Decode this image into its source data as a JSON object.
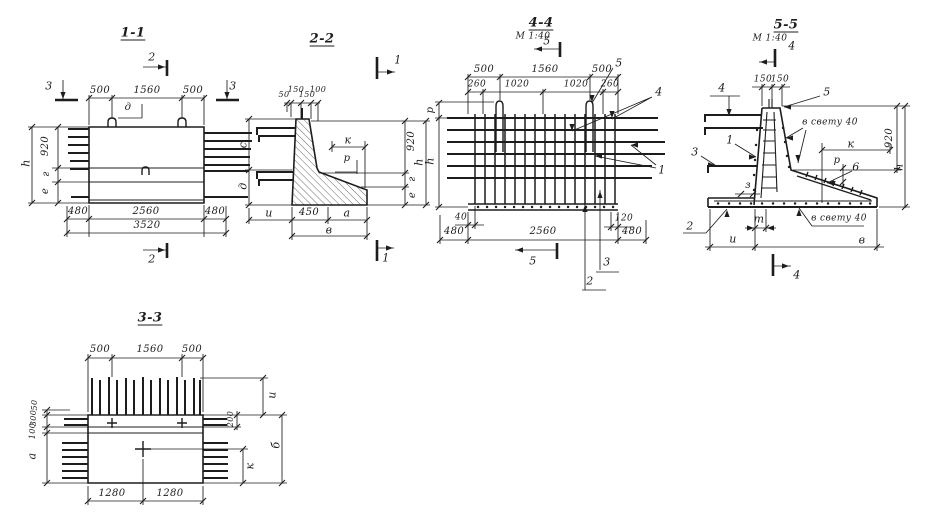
{
  "drawing": {
    "paper_color": "#ffffff",
    "ink_color": "#1d1d1d"
  },
  "views": [
    {
      "id": "section-1-1",
      "labels": [
        {
          "t": "1-1",
          "x": 133,
          "y": 33,
          "s": 13,
          "u": 1,
          "n": "view-title-1-1"
        },
        {
          "t": "2",
          "x": 152,
          "y": 57,
          "n": "section-mark-label"
        },
        {
          "t": "2",
          "x": 152,
          "y": 259,
          "n": "section-mark-label"
        },
        {
          "t": "3",
          "x": 49,
          "y": 86,
          "n": "section-mark-label"
        },
        {
          "t": "3",
          "x": 233,
          "y": 86,
          "n": "section-mark-label"
        },
        {
          "t": "500",
          "x": 100,
          "y": 91,
          "s": 10,
          "n": "dim-label"
        },
        {
          "t": "1560",
          "x": 147,
          "y": 91,
          "s": 10,
          "n": "dim-label"
        },
        {
          "t": "500",
          "x": 193,
          "y": 91,
          "s": 10,
          "n": "dim-label"
        },
        {
          "t": "д",
          "x": 128,
          "y": 108,
          "s": 10,
          "n": "param-label"
        },
        {
          "t": "920",
          "x": 46,
          "y": 146,
          "r": 1,
          "s": 10,
          "n": "dim-label"
        },
        {
          "t": "г",
          "x": 47,
          "y": 174,
          "r": 1,
          "s": 10,
          "n": "param-label"
        },
        {
          "t": "е",
          "x": 46,
          "y": 191,
          "r": 1,
          "s": 10,
          "n": "param-label"
        },
        {
          "t": "h",
          "x": 26,
          "y": 163,
          "r": 1,
          "n": "param-label"
        },
        {
          "t": "480",
          "x": 78,
          "y": 212,
          "s": 10,
          "n": "dim-label"
        },
        {
          "t": "2560",
          "x": 146,
          "y": 212,
          "s": 10,
          "n": "dim-label"
        },
        {
          "t": "480",
          "x": 215,
          "y": 212,
          "s": 10,
          "n": "dim-label"
        },
        {
          "t": "3520",
          "x": 147,
          "y": 226,
          "s": 10,
          "n": "dim-label"
        }
      ]
    },
    {
      "id": "section-2-2",
      "labels": [
        {
          "t": "2-2",
          "x": 322,
          "y": 39,
          "s": 13,
          "u": 1,
          "n": "view-title-2-2"
        },
        {
          "t": "1",
          "x": 398,
          "y": 60,
          "n": "section-mark-label"
        },
        {
          "t": "1",
          "x": 386,
          "y": 258,
          "n": "section-mark-label"
        },
        {
          "t": "50",
          "x": 284,
          "y": 95,
          "s": 8,
          "n": "dim-label"
        },
        {
          "t": "150",
          "x": 296,
          "y": 90,
          "s": 8,
          "n": "dim-label"
        },
        {
          "t": "150",
          "x": 307,
          "y": 95,
          "s": 8,
          "n": "dim-label"
        },
        {
          "t": "100",
          "x": 318,
          "y": 90,
          "s": 8,
          "n": "dim-label"
        },
        {
          "t": "с",
          "x": 243,
          "y": 145,
          "r": 1,
          "n": "param-label"
        },
        {
          "t": "д",
          "x": 243,
          "y": 186,
          "r": 1,
          "n": "param-label"
        },
        {
          "t": "и",
          "x": 269,
          "y": 213,
          "n": "param-label"
        },
        {
          "t": "450",
          "x": 309,
          "y": 213,
          "s": 10,
          "n": "dim-label"
        },
        {
          "t": "а",
          "x": 347,
          "y": 213,
          "n": "param-label"
        },
        {
          "t": "в",
          "x": 329,
          "y": 230,
          "n": "param-label"
        },
        {
          "t": "к",
          "x": 348,
          "y": 140,
          "n": "param-label"
        },
        {
          "t": "р",
          "x": 347,
          "y": 159,
          "s": 10,
          "n": "param-label"
        },
        {
          "t": "920",
          "x": 412,
          "y": 141,
          "r": 1,
          "s": 10,
          "n": "dim-label"
        },
        {
          "t": "г",
          "x": 413,
          "y": 179,
          "r": 1,
          "s": 10,
          "n": "param-label"
        },
        {
          "t": "е",
          "x": 413,
          "y": 195,
          "r": 1,
          "s": 10,
          "n": "param-label"
        },
        {
          "t": "h",
          "x": 419,
          "y": 162,
          "r": 1,
          "n": "param-label"
        }
      ]
    },
    {
      "id": "section-4-4",
      "labels": [
        {
          "t": "4-4",
          "x": 541,
          "y": 23,
          "s": 13,
          "u": 1,
          "n": "view-title-4-4"
        },
        {
          "t": "М 1:40",
          "x": 533,
          "y": 37,
          "s": 9,
          "n": "scale-label"
        },
        {
          "t": "5",
          "x": 547,
          "y": 41,
          "n": "section-mark-label"
        },
        {
          "t": "500",
          "x": 484,
          "y": 70,
          "s": 10,
          "n": "dim-label"
        },
        {
          "t": "1560",
          "x": 545,
          "y": 70,
          "s": 10,
          "n": "dim-label"
        },
        {
          "t": "500",
          "x": 602,
          "y": 70,
          "s": 10,
          "n": "dim-label"
        },
        {
          "t": "260",
          "x": 477,
          "y": 85,
          "s": 9,
          "n": "dim-label"
        },
        {
          "t": "1020",
          "x": 517,
          "y": 85,
          "s": 9,
          "n": "dim-label"
        },
        {
          "t": "1020",
          "x": 576,
          "y": 85,
          "s": 9,
          "n": "dim-label"
        },
        {
          "t": "260",
          "x": 610,
          "y": 85,
          "s": 9,
          "n": "dim-label"
        },
        {
          "t": "5",
          "x": 619,
          "y": 63,
          "n": "callout-label"
        },
        {
          "t": "4",
          "x": 659,
          "y": 92,
          "n": "callout-label"
        },
        {
          "t": "1",
          "x": 662,
          "y": 170,
          "n": "callout-label"
        },
        {
          "t": "р",
          "x": 431,
          "y": 110,
          "r": 1,
          "s": 10,
          "n": "param-label"
        },
        {
          "t": "h",
          "x": 430,
          "y": 161,
          "r": 1,
          "n": "param-label"
        },
        {
          "t": "40",
          "x": 461,
          "y": 218,
          "s": 9,
          "n": "dim-label"
        },
        {
          "t": "120",
          "x": 624,
          "y": 219,
          "s": 9,
          "n": "dim-label"
        },
        {
          "t": "480",
          "x": 454,
          "y": 232,
          "s": 10,
          "n": "dim-label"
        },
        {
          "t": "2560",
          "x": 543,
          "y": 232,
          "s": 10,
          "n": "dim-label"
        },
        {
          "t": "480",
          "x": 632,
          "y": 232,
          "s": 10,
          "n": "dim-label"
        },
        {
          "t": "5",
          "x": 533,
          "y": 261,
          "n": "section-mark-label"
        },
        {
          "t": "3",
          "x": 607,
          "y": 262,
          "n": "callout-label"
        },
        {
          "t": "2",
          "x": 590,
          "y": 281,
          "n": "callout-label"
        }
      ]
    },
    {
      "id": "section-5-5",
      "labels": [
        {
          "t": "5-5",
          "x": 786,
          "y": 25,
          "s": 13,
          "u": 1,
          "n": "view-title-5-5"
        },
        {
          "t": "М 1:40",
          "x": 770,
          "y": 39,
          "s": 9,
          "n": "scale-label"
        },
        {
          "t": "4",
          "x": 792,
          "y": 46,
          "n": "section-mark-label"
        },
        {
          "t": "150",
          "x": 763,
          "y": 80,
          "s": 9,
          "n": "dim-label"
        },
        {
          "t": "150",
          "x": 780,
          "y": 80,
          "s": 9,
          "n": "dim-label"
        },
        {
          "t": "4",
          "x": 722,
          "y": 88,
          "n": "callout-label"
        },
        {
          "t": "5",
          "x": 827,
          "y": 92,
          "n": "callout-label"
        },
        {
          "t": "в свету 40",
          "x": 830,
          "y": 123,
          "s": 9,
          "n": "note-label"
        },
        {
          "t": "1",
          "x": 730,
          "y": 140,
          "n": "callout-label"
        },
        {
          "t": "3",
          "x": 695,
          "y": 152,
          "n": "callout-label"
        },
        {
          "t": "з",
          "x": 748,
          "y": 186,
          "s": 10,
          "n": "param-label"
        },
        {
          "t": "2",
          "x": 690,
          "y": 226,
          "n": "callout-label"
        },
        {
          "t": "т",
          "x": 759,
          "y": 219,
          "n": "param-label"
        },
        {
          "t": "и",
          "x": 733,
          "y": 239,
          "n": "param-label"
        },
        {
          "t": "в",
          "x": 862,
          "y": 240,
          "n": "param-label"
        },
        {
          "t": "к",
          "x": 851,
          "y": 144,
          "n": "param-label"
        },
        {
          "t": "р",
          "x": 837,
          "y": 161,
          "s": 10,
          "n": "param-label"
        },
        {
          "t": "920",
          "x": 890,
          "y": 138,
          "r": 1,
          "s": 10,
          "n": "dim-label"
        },
        {
          "t": "h",
          "x": 899,
          "y": 167,
          "r": 1,
          "n": "param-label"
        },
        {
          "t": "6",
          "x": 856,
          "y": 167,
          "n": "callout-label"
        },
        {
          "t": "в свету 40",
          "x": 839,
          "y": 219,
          "s": 9,
          "n": "note-label"
        },
        {
          "t": "4",
          "x": 797,
          "y": 275,
          "n": "section-mark-label"
        }
      ]
    },
    {
      "id": "section-3-3",
      "labels": [
        {
          "t": "3-3",
          "x": 150,
          "y": 318,
          "s": 13,
          "u": 1,
          "n": "view-title-3-3"
        },
        {
          "t": "500",
          "x": 100,
          "y": 350,
          "s": 10,
          "n": "dim-label"
        },
        {
          "t": "1560",
          "x": 150,
          "y": 350,
          "s": 10,
          "n": "dim-label"
        },
        {
          "t": "500",
          "x": 192,
          "y": 350,
          "s": 10,
          "n": "dim-label"
        },
        {
          "t": "50",
          "x": 35,
          "y": 405,
          "r": 1,
          "s": 8,
          "n": "dim-label"
        },
        {
          "t": "300",
          "x": 34,
          "y": 418,
          "r": 1,
          "s": 8,
          "n": "dim-label"
        },
        {
          "t": "100",
          "x": 33,
          "y": 431,
          "r": 1,
          "s": 8,
          "n": "dim-label"
        },
        {
          "t": "а",
          "x": 32,
          "y": 456,
          "r": 1,
          "n": "param-label"
        },
        {
          "t": "и",
          "x": 272,
          "y": 395,
          "r": 1,
          "n": "param-label"
        },
        {
          "t": "200",
          "x": 231,
          "y": 419,
          "r": 1,
          "s": 8,
          "n": "dim-label"
        },
        {
          "t": "б",
          "x": 276,
          "y": 445,
          "r": 1,
          "n": "param-label"
        },
        {
          "t": "к",
          "x": 250,
          "y": 466,
          "r": 1,
          "n": "param-label"
        },
        {
          "t": "1280",
          "x": 112,
          "y": 494,
          "s": 10,
          "n": "dim-label"
        },
        {
          "t": "1280",
          "x": 170,
          "y": 494,
          "s": 10,
          "n": "dim-label"
        }
      ]
    }
  ]
}
